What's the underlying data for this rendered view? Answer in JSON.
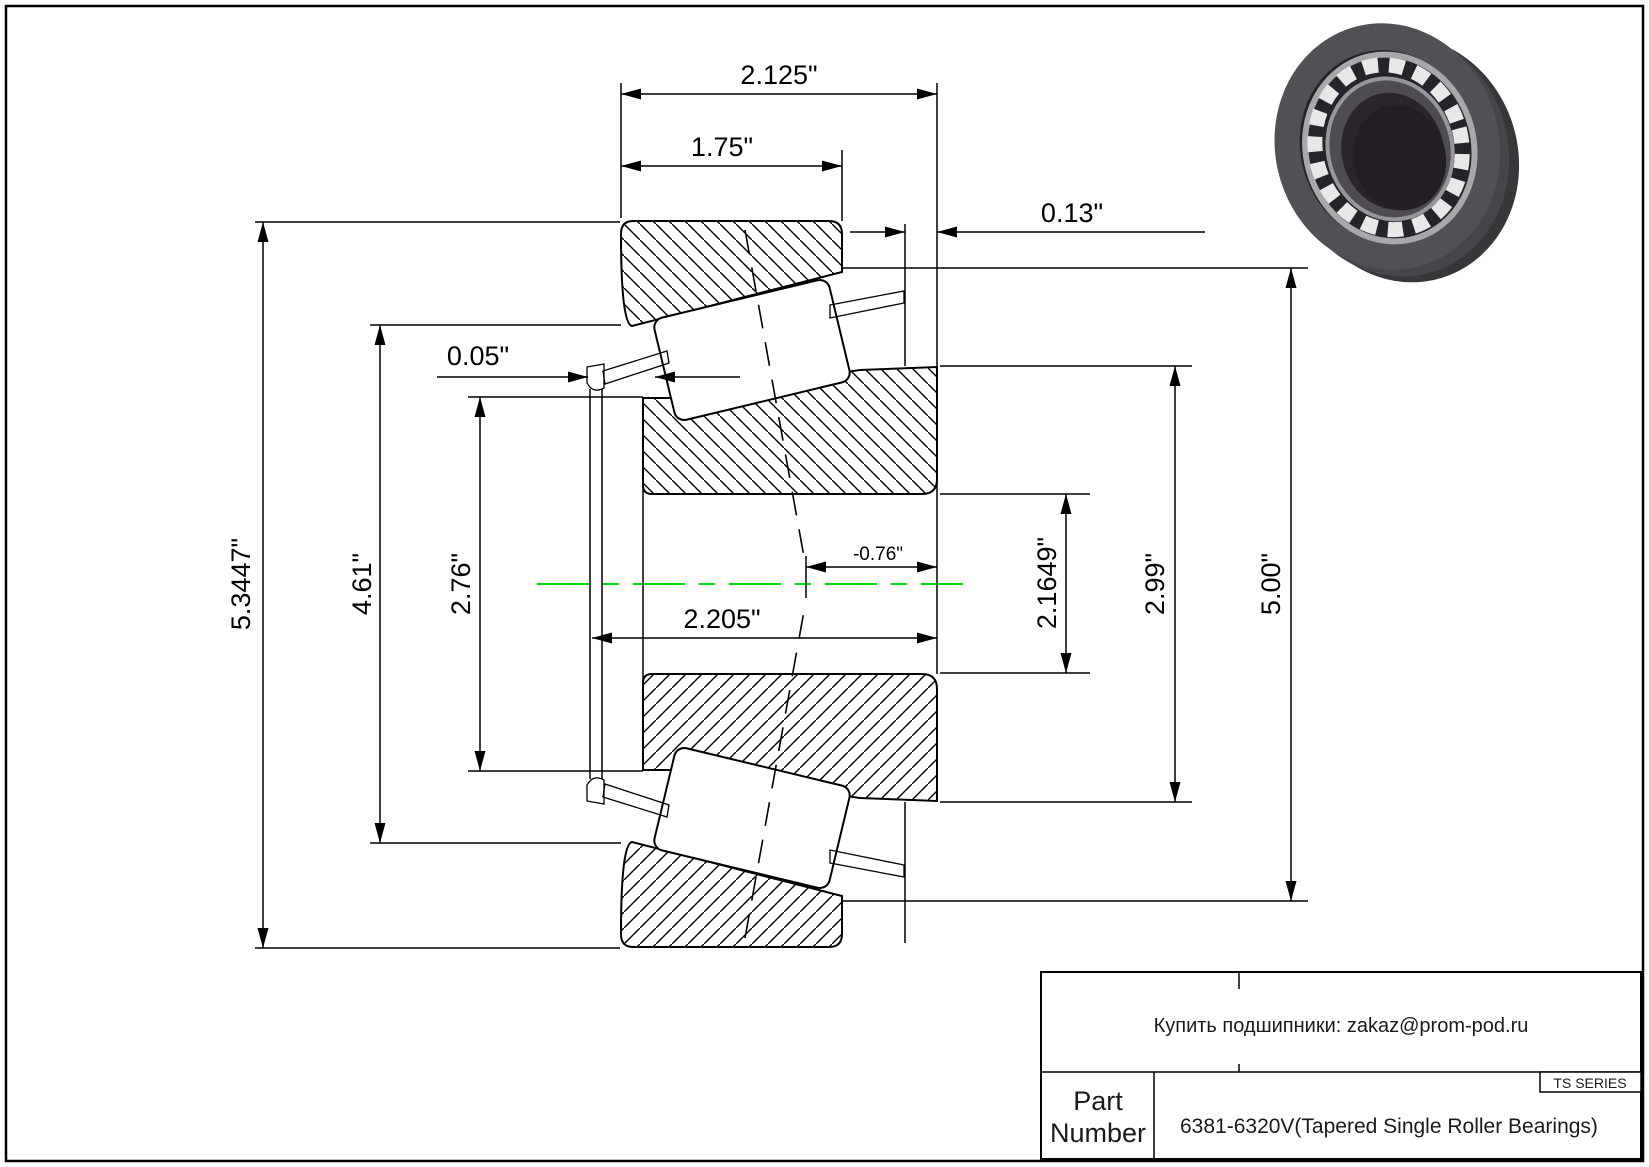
{
  "dims": {
    "cup_width": "2.125\"",
    "cup_front_width": "1.75\"",
    "cage_standout": "0.13\"",
    "cage_lip": "0.05\"",
    "flange_od": "5.3447\"",
    "cage_od": "4.61\"",
    "cone_front_od": "2.76\"",
    "overall_width": "2.205\"",
    "effective_center": "-0.76\"",
    "bore": "2.1649\"",
    "cone_od": "2.99\"",
    "cup_od": "5.00\""
  },
  "title_block": {
    "contact": "Купить подшипники: zakaz@prom-pod.ru",
    "series": "TS SERIES",
    "part_label_line1": "Part",
    "part_label_line2": "Number",
    "part_number": "6381-6320V(Tapered Single Roller Bearings)"
  },
  "colors": {
    "centerline": "#00dd00",
    "line": "#000000",
    "ring_dark": "#37373a",
    "ring_face": "#515155",
    "roller_white": "#e9e7e7"
  }
}
